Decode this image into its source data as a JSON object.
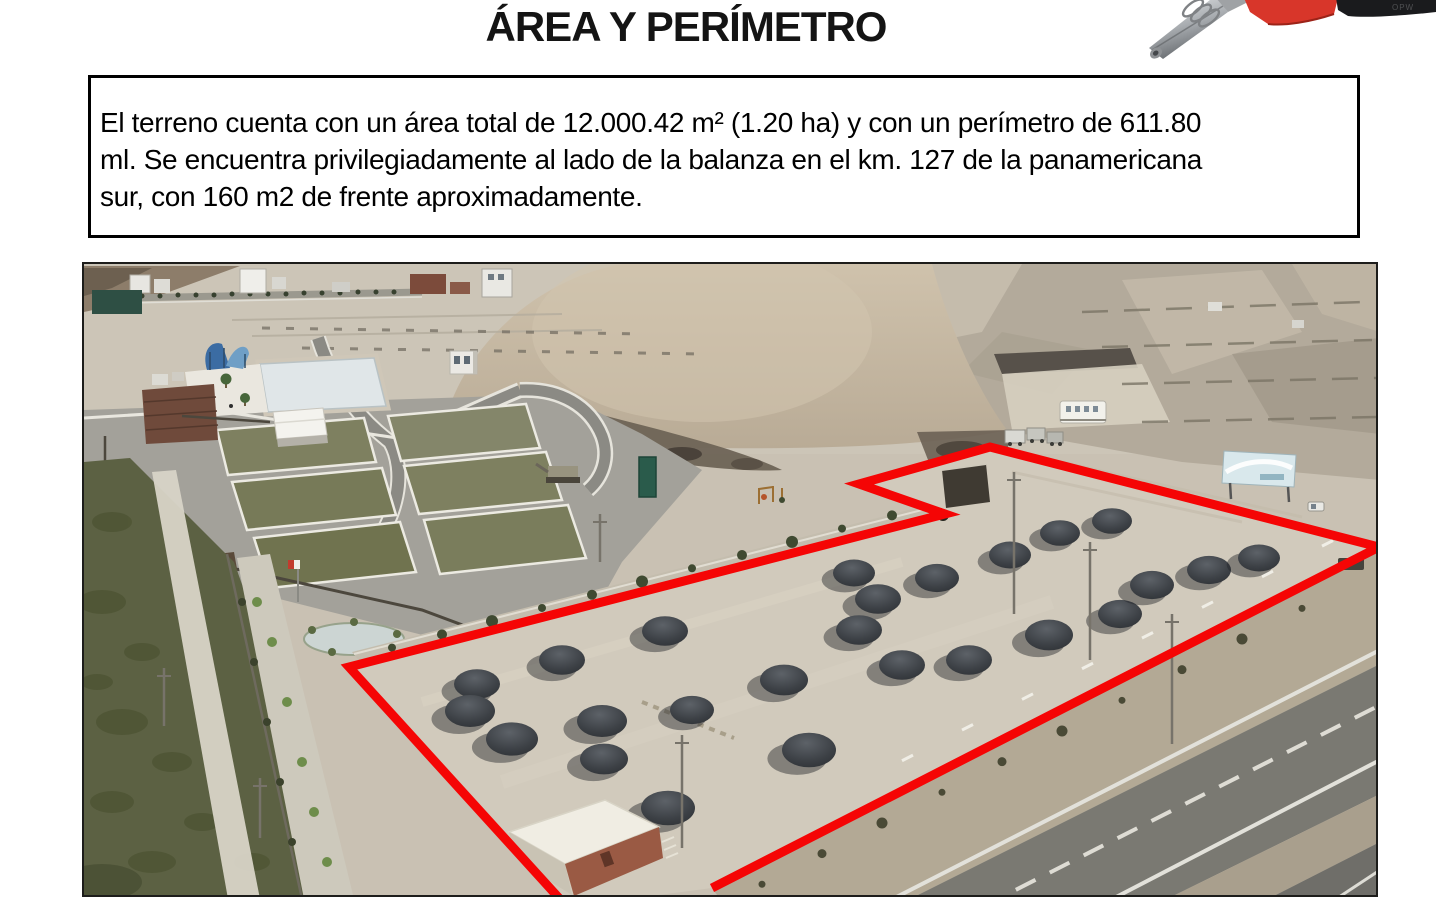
{
  "page": {
    "background": "#ffffff"
  },
  "header": {
    "title": "ÁREA Y PERÍMETRO"
  },
  "info_box": {
    "lines": [
      "El terreno cuenta con un área total de 12.000.42 m² (1.20 ha) y con un perímetro de 611.80",
      "ml. Se encuentra privilegiadamente al lado de la balanza en el km. 127 de la panamericana",
      "sur, con 160 m2 de frente aproximadamente."
    ]
  },
  "nozzle": {
    "brand_text": "OPW",
    "body_color": "#d8362a",
    "handle_color": "#1a1b1d",
    "spout_color": "#b9bcbf"
  },
  "photo": {
    "kind": "aerial-photo-of-terrain-next-to-panamericana-highway",
    "perimeter_annotation": {
      "color": "#f50505",
      "stroke_width": 9,
      "points": [
        [
          566,
          906
        ],
        [
          347,
          665
        ],
        [
          943,
          512
        ],
        [
          857,
          482
        ],
        [
          988,
          445
        ],
        [
          1377,
          545
        ],
        [
          710,
          886
        ]
      ]
    },
    "gravel_piles": [
      [
        475,
        682,
        46
      ],
      [
        468,
        709,
        50
      ],
      [
        510,
        737,
        52
      ],
      [
        560,
        658,
        46
      ],
      [
        600,
        719,
        50
      ],
      [
        602,
        757,
        48
      ],
      [
        663,
        629,
        46
      ],
      [
        666,
        806,
        54
      ],
      [
        690,
        708,
        44
      ],
      [
        782,
        678,
        48
      ],
      [
        807,
        748,
        54
      ],
      [
        852,
        571,
        42
      ],
      [
        876,
        597,
        46
      ],
      [
        857,
        628,
        46
      ],
      [
        900,
        663,
        46
      ],
      [
        935,
        576,
        44
      ],
      [
        967,
        658,
        46
      ],
      [
        1008,
        553,
        42
      ],
      [
        1047,
        633,
        48
      ],
      [
        1058,
        531,
        40
      ],
      [
        1110,
        519,
        40
      ],
      [
        1118,
        612,
        44
      ],
      [
        1150,
        583,
        44
      ],
      [
        1207,
        568,
        44
      ],
      [
        1257,
        556,
        42
      ]
    ],
    "power_poles": [
      [
        1012,
        470,
        612
      ],
      [
        1088,
        540,
        658
      ],
      [
        1170,
        612,
        742
      ],
      [
        680,
        733,
        846
      ],
      [
        598,
        512,
        560
      ],
      [
        162,
        666,
        724
      ],
      [
        258,
        776,
        836
      ]
    ]
  }
}
